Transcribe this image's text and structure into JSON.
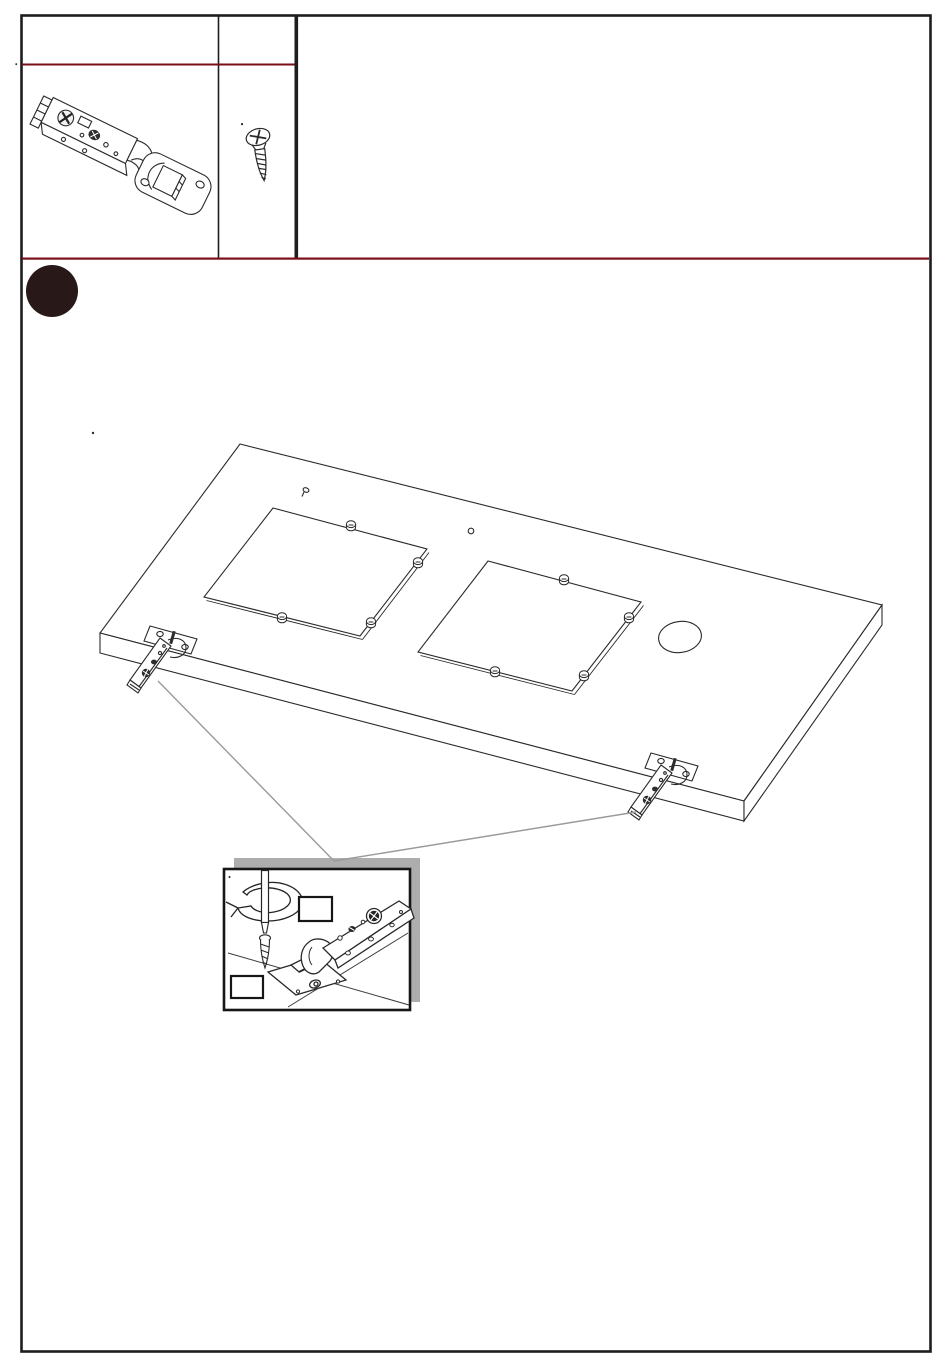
{
  "page": {
    "kind": "furniture-assembly-instruction-sheet",
    "background": "#ffffff",
    "visible_text": ""
  },
  "colors": {
    "accent_red": "#7a0f1a",
    "border_black": "#1d1d1d",
    "drawing_stroke": "#2a2a2a",
    "step_circle": "#281818",
    "shadow_gray": "#adadad",
    "leader_gray": "#9a9a9a",
    "screw_dark": "#2d2d2d"
  },
  "parts_table": {
    "cells": [
      "hinge-icon",
      "screw-icon"
    ]
  },
  "step_indicator": {
    "icon": "filled-circle-step-marker",
    "label": ""
  },
  "diagram": {
    "door_panel": {
      "glass_cutouts": 2,
      "glass_clips_per_cutout": 4,
      "round_hole": 1,
      "hinges_attached": 2,
      "small_pilot_marks": 2
    },
    "detail_inset": {
      "label_boxes": 2,
      "icons": [
        "screwdriver-icon",
        "rotation-arrow-icon",
        "screw-icon",
        "hinge-icon"
      ]
    }
  }
}
